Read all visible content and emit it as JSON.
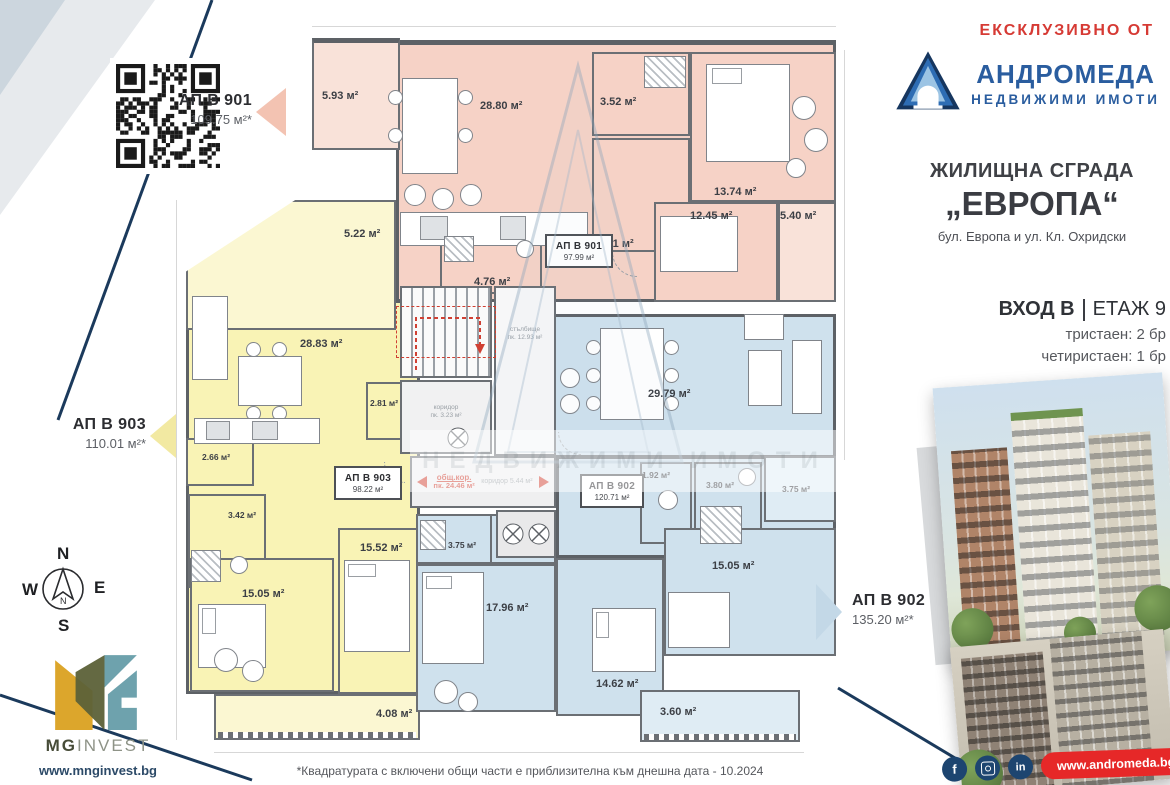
{
  "header": {
    "exclusive_label": "ЕКСКЛУЗИВНО ОТ",
    "agency_name": "АНДРОМЕДА",
    "agency_subtitle": "НЕДВИЖИМИ ИМОТИ"
  },
  "project": {
    "building_type": "ЖИЛИЩНА СГРАДА",
    "building_name": "„ЕВРОПА“",
    "address": "бул. Европа и ул. Кл. Охридски",
    "entrance_label": "ВХОД В",
    "floor_label": "ЕТАЖ 9",
    "unit_mix": [
      "тристаен: 2 бр",
      "четиристаен: 1 бр"
    ]
  },
  "apartment_callouts": [
    {
      "name": "АП В 901",
      "area": "109.75 м²*",
      "accent": "#f3c3b2",
      "direction": "left"
    },
    {
      "name": "АП В 903",
      "area": "110.01 м²*",
      "accent": "#f2e9a2",
      "direction": "left"
    },
    {
      "name": "АП В 902",
      "area": "135.20 м²*",
      "accent": "#c3d8e7",
      "direction": "right"
    }
  ],
  "plan": {
    "ap901": {
      "title": "АП В 901",
      "area": "97.99 м²",
      "color": "#f6d2c6",
      "rooms": [
        {
          "id": "balcony",
          "label": "5.93 м²"
        },
        {
          "id": "living-kitchen",
          "label": "28.80 м²"
        },
        {
          "id": "bathroom",
          "label": "3.52 м²"
        },
        {
          "id": "bedroom-1",
          "label": "13.74 м²"
        },
        {
          "id": "hallway",
          "label": "4.11 м²"
        },
        {
          "id": "bedroom-2",
          "label": "12.45 м²"
        },
        {
          "id": "terrace",
          "label": "5.40 м²"
        },
        {
          "id": "bathroom-2",
          "label": "4.76 м²"
        }
      ]
    },
    "ap903": {
      "title": "АП В 903",
      "area": "98.22 м²",
      "color": "#f9f3b5",
      "rooms": [
        {
          "id": "balcony-1",
          "label": "5.22 м²"
        },
        {
          "id": "living-kitchen",
          "label": "28.83 м²"
        },
        {
          "id": "storage",
          "label": "2.81 м²"
        },
        {
          "id": "hallway",
          "label": "2.66 м²"
        },
        {
          "id": "bathroom",
          "label": "3.42 м²"
        },
        {
          "id": "bedroom-1",
          "label": "15.05 м²"
        },
        {
          "id": "bedroom-2",
          "label": "15.52 м²"
        },
        {
          "id": "balcony-2",
          "label": "4.08 м²"
        }
      ]
    },
    "ap902": {
      "title": "АП В 902",
      "area": "120.71 м²",
      "color": "#cfe1ed",
      "rooms": [
        {
          "id": "living-kitchen",
          "label": "29.79 м²"
        },
        {
          "id": "wc",
          "label": "1.92 м²"
        },
        {
          "id": "bathroom",
          "label": "3.80 м²"
        },
        {
          "id": "hallway",
          "label": "3.75 м²"
        },
        {
          "id": "bathroom-2",
          "label": "3.75 м²"
        },
        {
          "id": "bedroom-1",
          "label": "17.96 м²"
        },
        {
          "id": "bedroom-2",
          "label": "14.62 м²"
        },
        {
          "id": "bedroom-3",
          "label": "15.05 м²"
        },
        {
          "id": "balcony",
          "label": "3.60 м²"
        }
      ]
    },
    "core": {
      "corridor_title": "общ.кор.",
      "corridor_area": "пк. 24.46 м²",
      "corridor_secondary": "коридор 5.44 м²",
      "stairs_label": "стълбище",
      "stairs_area": "пк. 12.93 м²",
      "lobby_label": "коридор",
      "lobby_area": "пк. 3.23 м²"
    },
    "watermark": "НЕДВИЖИМИ ИМОТИ"
  },
  "compass": {
    "north": "N",
    "east": "E",
    "south": "S",
    "west": "W"
  },
  "footer": {
    "disclaimer": "*Квадратурата с включени общи части е приблизителна към днешна дата - 10.2024",
    "developer_name_bold": "MG",
    "developer_name_rest": "INVEST",
    "developer_site": "www.mnginvest.bg",
    "andromeda_site": "www.andromeda.bg",
    "facebook_glyph": "f",
    "linkedin_glyph": "in"
  },
  "colors": {
    "brand_red": "#d63a34",
    "brand_blue": "#2a5d9f",
    "navy": "#1b3a5c",
    "banner_red": "#e62828",
    "wall": "#5d6166"
  }
}
